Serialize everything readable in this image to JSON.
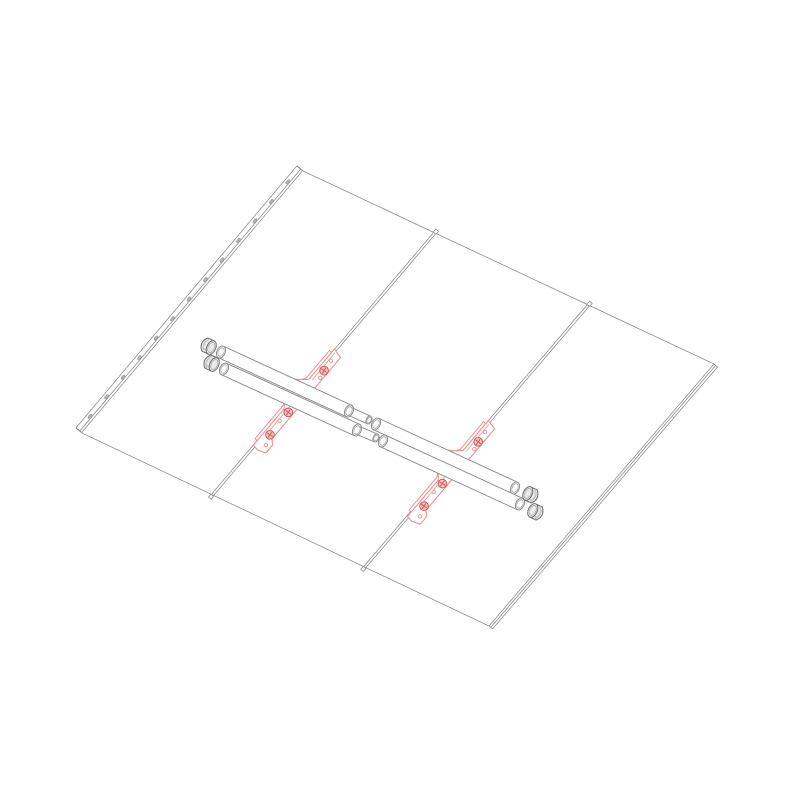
{
  "meta": {
    "description": "Exploded isometric line drawing: two-pipe snow-guard rail assembly with red seam clamps mounted on a three-panel standing-seam metal roof",
    "background": "#ffffff"
  },
  "colors": {
    "line": "#8f8f8f",
    "line_dark": "#6f6f6f",
    "line_inner": "#a8a8a8",
    "hole_fill": "#b5b5b5",
    "accent": "#ef8f8f",
    "accent_bold": "#d65c5c",
    "bolt_fill": "#f7caca",
    "cap_body": "#e9e9e9",
    "cap_mouth": "#f6f6f6",
    "cap_shade": "#c4c4c4",
    "white": "#ffffff"
  },
  "roof": {
    "corners": {
      "top": [
        303,
        171
      ],
      "right": [
        714,
        364
      ],
      "bottom": [
        489,
        626
      ],
      "left": [
        82,
        433
      ]
    },
    "seam_fractions": [
      0.318,
      0.692
    ],
    "seam_offsets": [
      0,
      2.4
    ],
    "right_edge_offsets": [
      0,
      2.2,
      4.6
    ],
    "edge_rail": {
      "offsets": [
        -0.5,
        -3,
        -8
      ],
      "hole_offset": -4.6,
      "hole_count": 13,
      "hole_rx": 2.6,
      "hole_ry": 1.3
    }
  },
  "rails": [
    {
      "name": "upper",
      "radius": 6.3,
      "sleeve_radius": 4.2,
      "seg1": [
        [
          221,
          352
        ],
        [
          349,
          411
        ]
      ],
      "sleeve": [
        [
          349,
          411
        ],
        [
          369,
          420
        ]
      ],
      "seg2": [
        [
          376,
          424
        ],
        [
          515,
          488
        ]
      ],
      "cap_left": [
        208,
        346
      ],
      "cap_right": [
        531,
        495
      ]
    },
    {
      "name": "lower",
      "radius": 6.3,
      "sleeve_radius": 4.2,
      "seg1": [
        [
          224,
          369
        ],
        [
          357,
          430
        ]
      ],
      "sleeve": [
        [
          357,
          430
        ],
        [
          376,
          438
        ]
      ],
      "seg2": [
        [
          383,
          441
        ],
        [
          520,
          504
        ]
      ],
      "cap_left": [
        211,
        363
      ],
      "cap_right": [
        536,
        512
      ]
    }
  ],
  "cap_radius": 7.2,
  "cap_half_len": 3.6,
  "brackets": [
    {
      "name": "left",
      "anchor": [
        300.6,
        388.7
      ]
    },
    {
      "name": "right",
      "anchor": [
        454.7,
        460.0
      ]
    }
  ],
  "bracket_template": {
    "plate": [
      [
        -4,
        0.3
      ],
      [
        -1.5,
        10.5
      ],
      [
        105,
        10.5
      ],
      [
        109,
        15
      ],
      [
        119.5,
        15
      ],
      [
        122.5,
        6.5
      ],
      [
        121.5,
        0.3
      ],
      [
        74,
        0.3
      ],
      [
        70,
        -2.8
      ],
      [
        66,
        -7
      ],
      [
        59,
        -9.6
      ],
      [
        48,
        -9.6
      ],
      [
        42,
        -7
      ],
      [
        38,
        -2.6
      ],
      [
        35.5,
        0.3
      ]
    ],
    "far_plate": [
      [
        0,
        -2.6
      ],
      [
        36,
        -2.6
      ],
      [
        41,
        -5.6
      ],
      [
        45,
        -12
      ],
      [
        52,
        -14
      ],
      [
        61,
        -13
      ],
      [
        67,
        -7.6
      ],
      [
        71,
        -2.6
      ],
      [
        115.5,
        -2.6
      ],
      [
        116,
        2
      ],
      [
        0.5,
        2
      ]
    ],
    "inner_lines": [
      [
        [
          -1,
          3.2
        ],
        [
          34,
          3.2
        ]
      ],
      [
        [
          42,
          3.2
        ],
        [
          104,
          3.2
        ]
      ]
    ],
    "bolts": [
      [
        19,
        6.3
      ],
      [
        74,
        5.8
      ],
      [
        103,
        6.3
      ]
    ],
    "bolt_r": 4.3,
    "holes": [
      [
        7,
        5.2
      ],
      [
        27,
        8
      ],
      [
        86,
        4.6
      ],
      [
        113.5,
        9.8
      ]
    ],
    "hole_r": 1.7
  }
}
